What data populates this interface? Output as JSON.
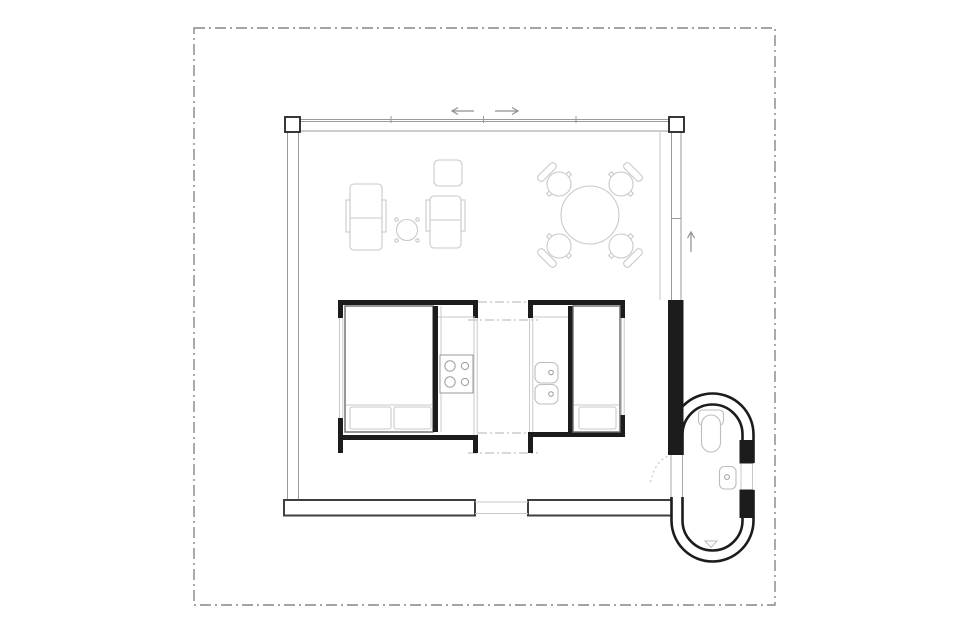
{
  "canvas": {
    "width": 960,
    "height": 639,
    "background": "#ffffff"
  },
  "colors": {
    "ink": "#1c1c1c",
    "wall_gray": "#9a9a9a",
    "light_gray": "#c9c9c9",
    "fixture_gray": "#bdbdbd",
    "band_gray": "#3f3f3f",
    "border_gray": "#868686",
    "arrow_gray": "#8f8f8f",
    "dashdot_gray": "#b3b3b3"
  },
  "drawing": {
    "kind": "architectural floor plan, one-room cabin with round bathroom pod",
    "site_boundary": {
      "style": "dash-dot rectangle",
      "x": 194,
      "y": 28,
      "width": 581,
      "height": 577
    },
    "shell": {
      "glazed_walls": [
        "top",
        "left",
        "right"
      ],
      "columns": 2,
      "mullions_top_x": [
        391,
        483,
        576
      ]
    },
    "annotations": {
      "arrows": [
        {
          "id": "sliding-door-left",
          "direction": "left"
        },
        {
          "id": "sliding-door-right",
          "direction": "right"
        },
        {
          "id": "entry-path-up",
          "direction": "up"
        }
      ],
      "door_swing": "dotted arc at bathroom pod entrance"
    },
    "furniture": {
      "living": [
        {
          "name": "armchair",
          "count": 2
        },
        {
          "name": "round-side-table",
          "count": 1
        },
        {
          "name": "square-ottoman",
          "count": 1
        },
        {
          "name": "round-dining-table",
          "count": 1
        },
        {
          "name": "dining-chair",
          "count": 4
        }
      ],
      "module_left": [
        {
          "name": "double-bed",
          "pillows": 2
        },
        {
          "name": "cooktop",
          "burners": 4
        }
      ],
      "module_right": [
        {
          "name": "single-bed",
          "pillows": 1
        },
        {
          "name": "double-basin-counter",
          "basins": 2
        }
      ],
      "bathroom_pod": [
        {
          "name": "toilet"
        },
        {
          "name": "washbasin"
        },
        {
          "name": "shower-drain-triangle"
        },
        {
          "name": "wall-niche-window"
        }
      ]
    }
  }
}
